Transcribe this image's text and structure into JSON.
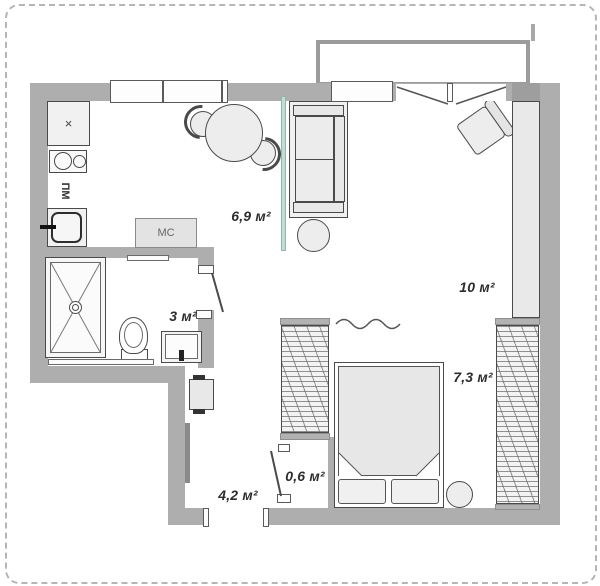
{
  "plan": {
    "type": "apartment-floor-plan",
    "rooms": [
      {
        "name": "kitchen",
        "area_label": "6,9 м²"
      },
      {
        "name": "living-room",
        "area_label": "10 м²"
      },
      {
        "name": "bathroom",
        "area_label": "3 м²"
      },
      {
        "name": "bedroom",
        "area_label": "7,3 м²"
      },
      {
        "name": "hallway",
        "area_label": "4,2 м²"
      },
      {
        "name": "closet",
        "area_label": "0,6 м²"
      }
    ],
    "appliances": {
      "washing_machine_label": "МС",
      "dishwasher_label": "ПМ",
      "hob_cabinet_label": "×"
    },
    "colors": {
      "wall": "#aeaeae",
      "furniture_line": "#4a4a4a",
      "glass_partition": "#c3dcd2",
      "dashed_border": "#b5b5b5"
    }
  }
}
